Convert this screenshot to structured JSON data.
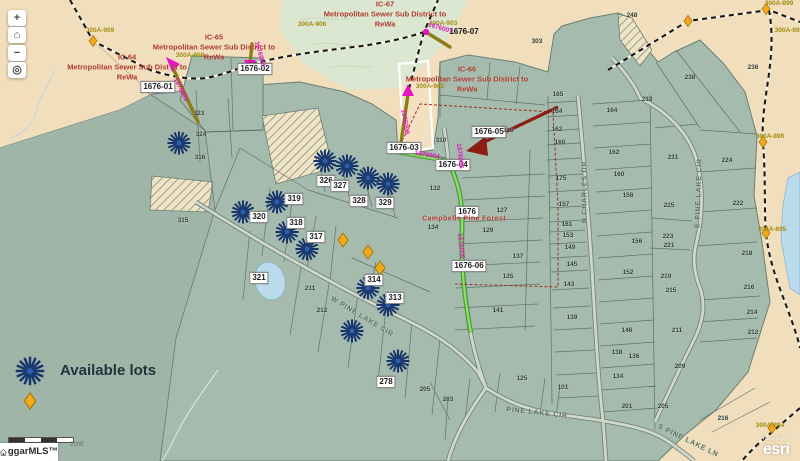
{
  "map": {
    "colors": {
      "tan": "#f1debc",
      "sage": "#a4bbae",
      "sage_dark": "#9fb5a7",
      "forest": "#dbe7d0",
      "water": "#b9dbeb",
      "road_fill": "#ced8cb",
      "road_casing": "#76857a",
      "sewer_green": "#3f9e2c",
      "force_main_olive": "#8d7d18",
      "magenta": "#e316c0",
      "district_red": "#ad3a2a",
      "olive_label": "#a18d0e",
      "burst_blue": "#17356b",
      "diamond_orange": "#f2a81d",
      "arrow_dark_red": "#8b1d15"
    },
    "controls": [
      {
        "name": "zoom-in",
        "glyph": "+"
      },
      {
        "name": "home",
        "glyph": "⌂"
      },
      {
        "name": "zoom-out",
        "glyph": "−"
      },
      {
        "name": "locate",
        "glyph": "◎"
      }
    ],
    "legend": {
      "available_lots_label": "Available lots"
    },
    "scale_label": "200ft",
    "watermark_text": "ggarMLS™",
    "esri": {
      "powered_by": "Powered by",
      "brand": "esri"
    },
    "districts": [
      {
        "id": "IC-67",
        "body": "Metropolitan Sewer Sub District to",
        "org": "ReWa",
        "x": 385,
        "y": 14
      },
      {
        "id": "IC-65",
        "body": "Metropolitan Sewer Sub District to",
        "org": "ReWa",
        "x": 214,
        "y": 47
      },
      {
        "id": "IC-64",
        "body": "Metropolitan Sewer Sub Dist ct to",
        "org": "ReWa",
        "x": 127,
        "y": 67
      },
      {
        "id": "IC-66",
        "body": "Metropolitan Sewer Sub District to",
        "org": "ReWa",
        "x": 467,
        "y": 79
      }
    ],
    "sewer_point_labels": [
      {
        "t": "1676-01",
        "x": 158,
        "y": 87
      },
      {
        "t": "1676-02",
        "x": 255,
        "y": 69
      },
      {
        "t": "1676-03",
        "x": 404,
        "y": 148
      },
      {
        "t": "1676-04",
        "x": 453,
        "y": 165
      },
      {
        "t": "1676-05",
        "x": 489,
        "y": 132
      },
      {
        "t": "1676-06",
        "x": 469,
        "y": 266
      },
      {
        "t": "1676",
        "x": 467,
        "y": 212
      }
    ],
    "plain_labels": [
      {
        "t": "1676-07",
        "x": 464,
        "y": 32
      }
    ],
    "lot_labels": [
      {
        "t": "326",
        "x": 326,
        "y": 181
      },
      {
        "t": "327",
        "x": 340,
        "y": 186
      },
      {
        "t": "328",
        "x": 359,
        "y": 201
      },
      {
        "t": "329",
        "x": 385,
        "y": 203
      },
      {
        "t": "319",
        "x": 294,
        "y": 199
      },
      {
        "t": "320",
        "x": 259,
        "y": 217
      },
      {
        "t": "318",
        "x": 296,
        "y": 223
      },
      {
        "t": "317",
        "x": 316,
        "y": 237
      },
      {
        "t": "321",
        "x": 259,
        "y": 278
      },
      {
        "t": "314",
        "x": 374,
        "y": 280
      },
      {
        "t": "313",
        "x": 395,
        "y": 298
      },
      {
        "t": "278",
        "x": 386,
        "y": 382
      }
    ],
    "parcel_numbers": [
      [
        "323",
        199,
        114
      ],
      [
        "324",
        201,
        135
      ],
      [
        "316",
        200,
        158
      ],
      [
        "315",
        183,
        221
      ],
      [
        "303",
        537,
        42
      ],
      [
        "310",
        441,
        141
      ],
      [
        "315",
        508,
        131
      ],
      [
        "132",
        435,
        189
      ],
      [
        "134",
        433,
        228
      ],
      [
        "127",
        502,
        211
      ],
      [
        "129",
        488,
        231
      ],
      [
        "137",
        518,
        257
      ],
      [
        "135",
        508,
        277
      ],
      [
        "141",
        498,
        311
      ],
      [
        "211",
        310,
        289
      ],
      [
        "212",
        322,
        311
      ],
      [
        "248",
        632,
        16
      ],
      [
        "238",
        690,
        78
      ],
      [
        "236",
        753,
        68
      ],
      [
        "233",
        647,
        100
      ],
      [
        "231",
        673,
        158
      ],
      [
        "224",
        727,
        161
      ],
      [
        "225",
        669,
        206
      ],
      [
        "222",
        738,
        204
      ],
      [
        "223",
        668,
        237
      ],
      [
        "221",
        669,
        246
      ],
      [
        "218",
        747,
        254
      ],
      [
        "216",
        749,
        288
      ],
      [
        "214",
        752,
        313
      ],
      [
        "212",
        753,
        333
      ],
      [
        "219",
        666,
        277
      ],
      [
        "215",
        671,
        291
      ],
      [
        "211",
        677,
        331
      ],
      [
        "209",
        680,
        367
      ],
      [
        "165",
        558,
        95
      ],
      [
        "164",
        557,
        112
      ],
      [
        "162",
        557,
        130
      ],
      [
        "160",
        560,
        143
      ],
      [
        "175",
        561,
        179
      ],
      [
        "157",
        564,
        205
      ],
      [
        "161",
        567,
        225
      ],
      [
        "153",
        568,
        236
      ],
      [
        "149",
        570,
        248
      ],
      [
        "145",
        572,
        265
      ],
      [
        "143",
        569,
        285
      ],
      [
        "139",
        572,
        318
      ],
      [
        "101",
        563,
        388
      ],
      [
        "164",
        612,
        111
      ],
      [
        "162",
        614,
        153
      ],
      [
        "160",
        619,
        175
      ],
      [
        "158",
        628,
        196
      ],
      [
        "156",
        637,
        242
      ],
      [
        "152",
        628,
        273
      ],
      [
        "146",
        627,
        331
      ],
      [
        "138",
        617,
        353
      ],
      [
        "136",
        634,
        357
      ],
      [
        "134",
        618,
        377
      ],
      [
        "205",
        425,
        390
      ],
      [
        "203",
        448,
        400
      ],
      [
        "125",
        522,
        379
      ],
      [
        "201",
        627,
        407
      ],
      [
        "205",
        663,
        407
      ],
      [
        "216",
        723,
        419
      ]
    ],
    "road_labels": [
      {
        "t": "W PINE LAKE CIR",
        "x": 362,
        "y": 317,
        "rot": 31
      },
      {
        "t": "PINE LAKE CIR",
        "x": 537,
        "y": 413,
        "rot": 6
      },
      {
        "t": "N CHARLES DR",
        "x": 585,
        "y": 192,
        "rot": -90
      },
      {
        "t": "E PINE LAKE CIR",
        "x": 699,
        "y": 193,
        "rot": -88
      },
      {
        "t": "S PINE LAKE LN",
        "x": 688,
        "y": 441,
        "rot": 26
      }
    ],
    "olive_labels": [
      {
        "t": "300A-909",
        "x": 100,
        "y": 31
      },
      {
        "t": "300A-908",
        "x": 190,
        "y": 56
      },
      {
        "t": "300A-906",
        "x": 312,
        "y": 25
      },
      {
        "t": "300A-903",
        "x": 443,
        "y": 24
      },
      {
        "t": "300A-902",
        "x": 430,
        "y": 87
      },
      {
        "t": "300A-899",
        "x": 779,
        "y": 4
      },
      {
        "t": "300A-898",
        "x": 789,
        "y": 31
      },
      {
        "t": "300A-896",
        "x": 770,
        "y": 137
      },
      {
        "t": "300A-895",
        "x": 772,
        "y": 230
      },
      {
        "t": "300A-894",
        "x": 770,
        "y": 426
      }
    ],
    "magenta_labels": [
      {
        "t": "1676001",
        "x": 180,
        "y": 90,
        "rot": 63
      },
      {
        "t": "1676002",
        "x": 259,
        "y": 54,
        "rot": 74
      },
      {
        "t": "1676003",
        "x": 404,
        "y": 122,
        "rot": 80
      },
      {
        "t": "1676004",
        "x": 427,
        "y": 156,
        "rot": 9
      },
      {
        "t": "1676005",
        "x": 459,
        "y": 156,
        "rot": 84
      },
      {
        "t": "1676006",
        "x": 460,
        "y": 246,
        "rot": 84
      },
      {
        "t": "1676007",
        "x": 440,
        "y": 29,
        "rot": 16
      }
    ],
    "subdivision_label": {
      "t": "Campbells Pine Forest",
      "x": 464,
      "y": 219
    },
    "markers": {
      "starbursts": [
        [
          179,
          143
        ],
        [
          325,
          161
        ],
        [
          347,
          166
        ],
        [
          368,
          178
        ],
        [
          388,
          184
        ],
        [
          277,
          202
        ],
        [
          243,
          212
        ],
        [
          287,
          232
        ],
        [
          307,
          249
        ],
        [
          368,
          288
        ],
        [
          388,
          305
        ],
        [
          352,
          331
        ],
        [
          398,
          361
        ]
      ],
      "legend_starburst": [
        30,
        371
      ],
      "lot_diamonds": [
        [
          343,
          240
        ],
        [
          368,
          252
        ],
        [
          380,
          268
        ]
      ],
      "legend_diamond": [
        30,
        401
      ],
      "boundary_diamonds": [
        [
          93,
          41
        ],
        [
          688,
          21
        ],
        [
          766,
          9
        ],
        [
          763,
          142
        ],
        [
          766,
          233
        ],
        [
          772,
          428
        ]
      ]
    }
  }
}
